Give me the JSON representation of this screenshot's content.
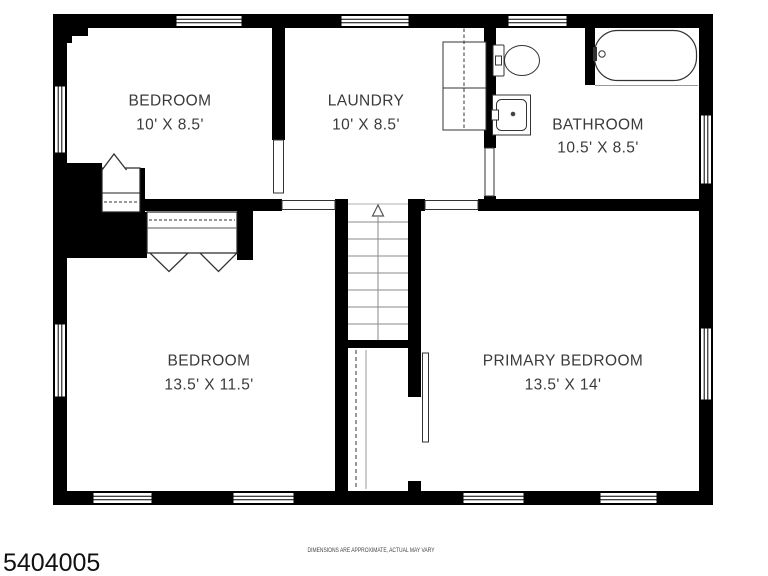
{
  "rooms": {
    "bedroom_top": {
      "name": "BEDROOM",
      "dims": "10' X 8.5'"
    },
    "laundry": {
      "name": "LAUNDRY",
      "dims": "10' X 8.5'"
    },
    "bathroom": {
      "name": "BATHROOM",
      "dims": "10.5' X 8.5'"
    },
    "bedroom_lower": {
      "name": "BEDROOM",
      "dims": "13.5' X 11.5'"
    },
    "primary_bedroom": {
      "name": "PRIMARY BEDROOM",
      "dims": "13.5' X 14'"
    }
  },
  "footer": {
    "disclaimer": "DIMENSIONS ARE APPROXIMATE, ACTUAL MAY VARY",
    "listing_id": "5404005"
  },
  "fixtures": {
    "washer_dryer": "stacked-washer-dryer",
    "toilet": "toilet",
    "sink": "sink",
    "bathtub": "bathtub",
    "stairs": "staircase-up",
    "closets": "closets-with-rods"
  },
  "colors": {
    "wall": "#000000",
    "background": "#ffffff",
    "fixture_line": "#333333",
    "text": "#3a3a3a"
  }
}
